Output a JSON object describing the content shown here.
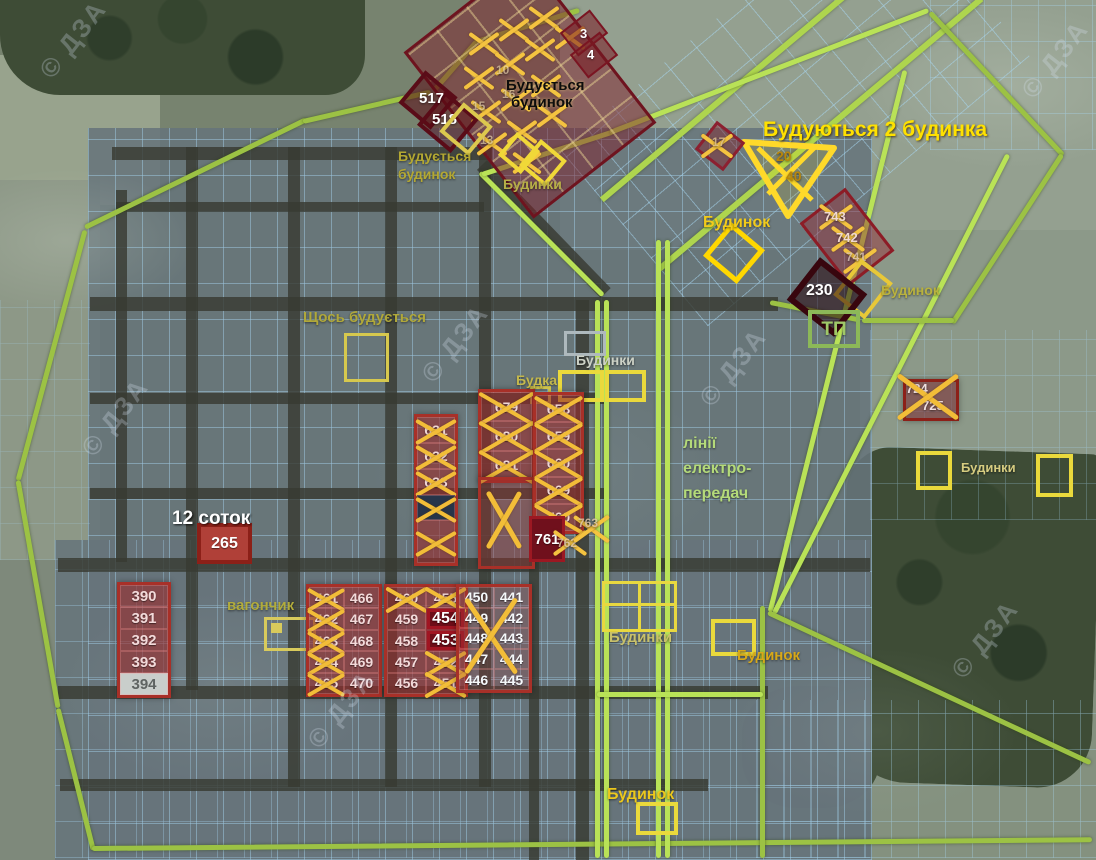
{
  "watermark": "© ДЗА",
  "labels": {
    "building_house_top": {
      "l1": "Будується",
      "l2": "будинок"
    },
    "building_house_left": {
      "l1": "Будується",
      "l2": "будинок"
    },
    "two_houses_building": "Будуються 2 будинка",
    "houses_top": "Будинки",
    "house_top_right": "Будинок",
    "house_right": "Будинок",
    "tp": "ТП",
    "something_building": "Щось будується",
    "houses_mid": "Будинки",
    "budka": "Будка",
    "power_lines": {
      "l1": "лінії",
      "l2": "електро-",
      "l3": "передач"
    },
    "twelve_sotok": "12 соток",
    "vagonchik": "вагончик",
    "houses_bottom": "Будинки",
    "house_bottom_right": "Будинок",
    "houses_right": "Будинки",
    "house_bottom": "Будинок"
  },
  "plots": {
    "p3": "3",
    "p4": "4",
    "p517": "517",
    "p518": "518",
    "p230": "230",
    "p265": "265",
    "p761": "761",
    "p762": "762",
    "p763": "763",
    "t17": "17",
    "t20": "20",
    "t40": "40",
    "p724": "724",
    "p725": "725",
    "b743": "743",
    "b742": "742",
    "b741": "741",
    "cluster_numbers": [
      "10",
      "15",
      "16",
      "13"
    ],
    "col631": [
      {
        "n": "631",
        "x": true
      },
      {
        "n": "632",
        "x": true
      },
      {
        "n": "633",
        "x": true
      },
      {
        "n": "",
        "x": true,
        "dark": true
      },
      {
        "n": "",
        "x": true,
        "tall": true
      }
    ],
    "col679": [
      {
        "n": "679",
        "x": true
      },
      {
        "n": "680",
        "x": true
      },
      {
        "n": "681",
        "x": true
      }
    ],
    "col658": [
      {
        "n": "658",
        "x": true
      },
      {
        "n": "659",
        "x": true
      },
      {
        "n": "660",
        "x": true
      },
      {
        "n": "669",
        "x": true
      },
      {
        "n": "760",
        "x": true
      }
    ],
    "col390": [
      {
        "n": "390"
      },
      {
        "n": "391"
      },
      {
        "n": "392"
      },
      {
        "n": "393"
      },
      {
        "n": "394",
        "light": true
      }
    ],
    "blockA_left": [
      {
        "n": "461",
        "x": true
      },
      {
        "n": "462",
        "x": true
      },
      {
        "n": "463",
        "x": true
      },
      {
        "n": "464",
        "x": true
      },
      {
        "n": "465",
        "x": true
      }
    ],
    "blockA_right": [
      {
        "n": "466"
      },
      {
        "n": "467"
      },
      {
        "n": "468"
      },
      {
        "n": "469"
      },
      {
        "n": "470"
      }
    ],
    "blockB_left": [
      {
        "n": "460",
        "x": true
      },
      {
        "n": "459"
      },
      {
        "n": "458"
      },
      {
        "n": "457"
      },
      {
        "n": "456"
      }
    ],
    "blockB_right": [
      {
        "n": "455",
        "x": true
      },
      {
        "n": "454",
        "hl": true
      },
      {
        "n": "453",
        "hl": true
      },
      {
        "n": "452",
        "x": true
      },
      {
        "n": "451",
        "x": true
      }
    ],
    "blockC_left": [
      {
        "n": "450"
      },
      {
        "n": "449"
      },
      {
        "n": "448"
      },
      {
        "n": "447"
      },
      {
        "n": "446"
      }
    ],
    "blockC_right": [
      {
        "n": "441"
      },
      {
        "n": "442"
      },
      {
        "n": "443"
      },
      {
        "n": "444"
      },
      {
        "n": "445"
      }
    ]
  },
  "colors": {
    "plot_grid": "#a8d8f4",
    "boundary_green": "#9cc244",
    "power_green": "#b9e257",
    "highlight_yellow": "#ffd92a",
    "cross_orange": "#f2bd38",
    "plot_red": "#a83028",
    "label_khaki": "#b6ae46"
  }
}
